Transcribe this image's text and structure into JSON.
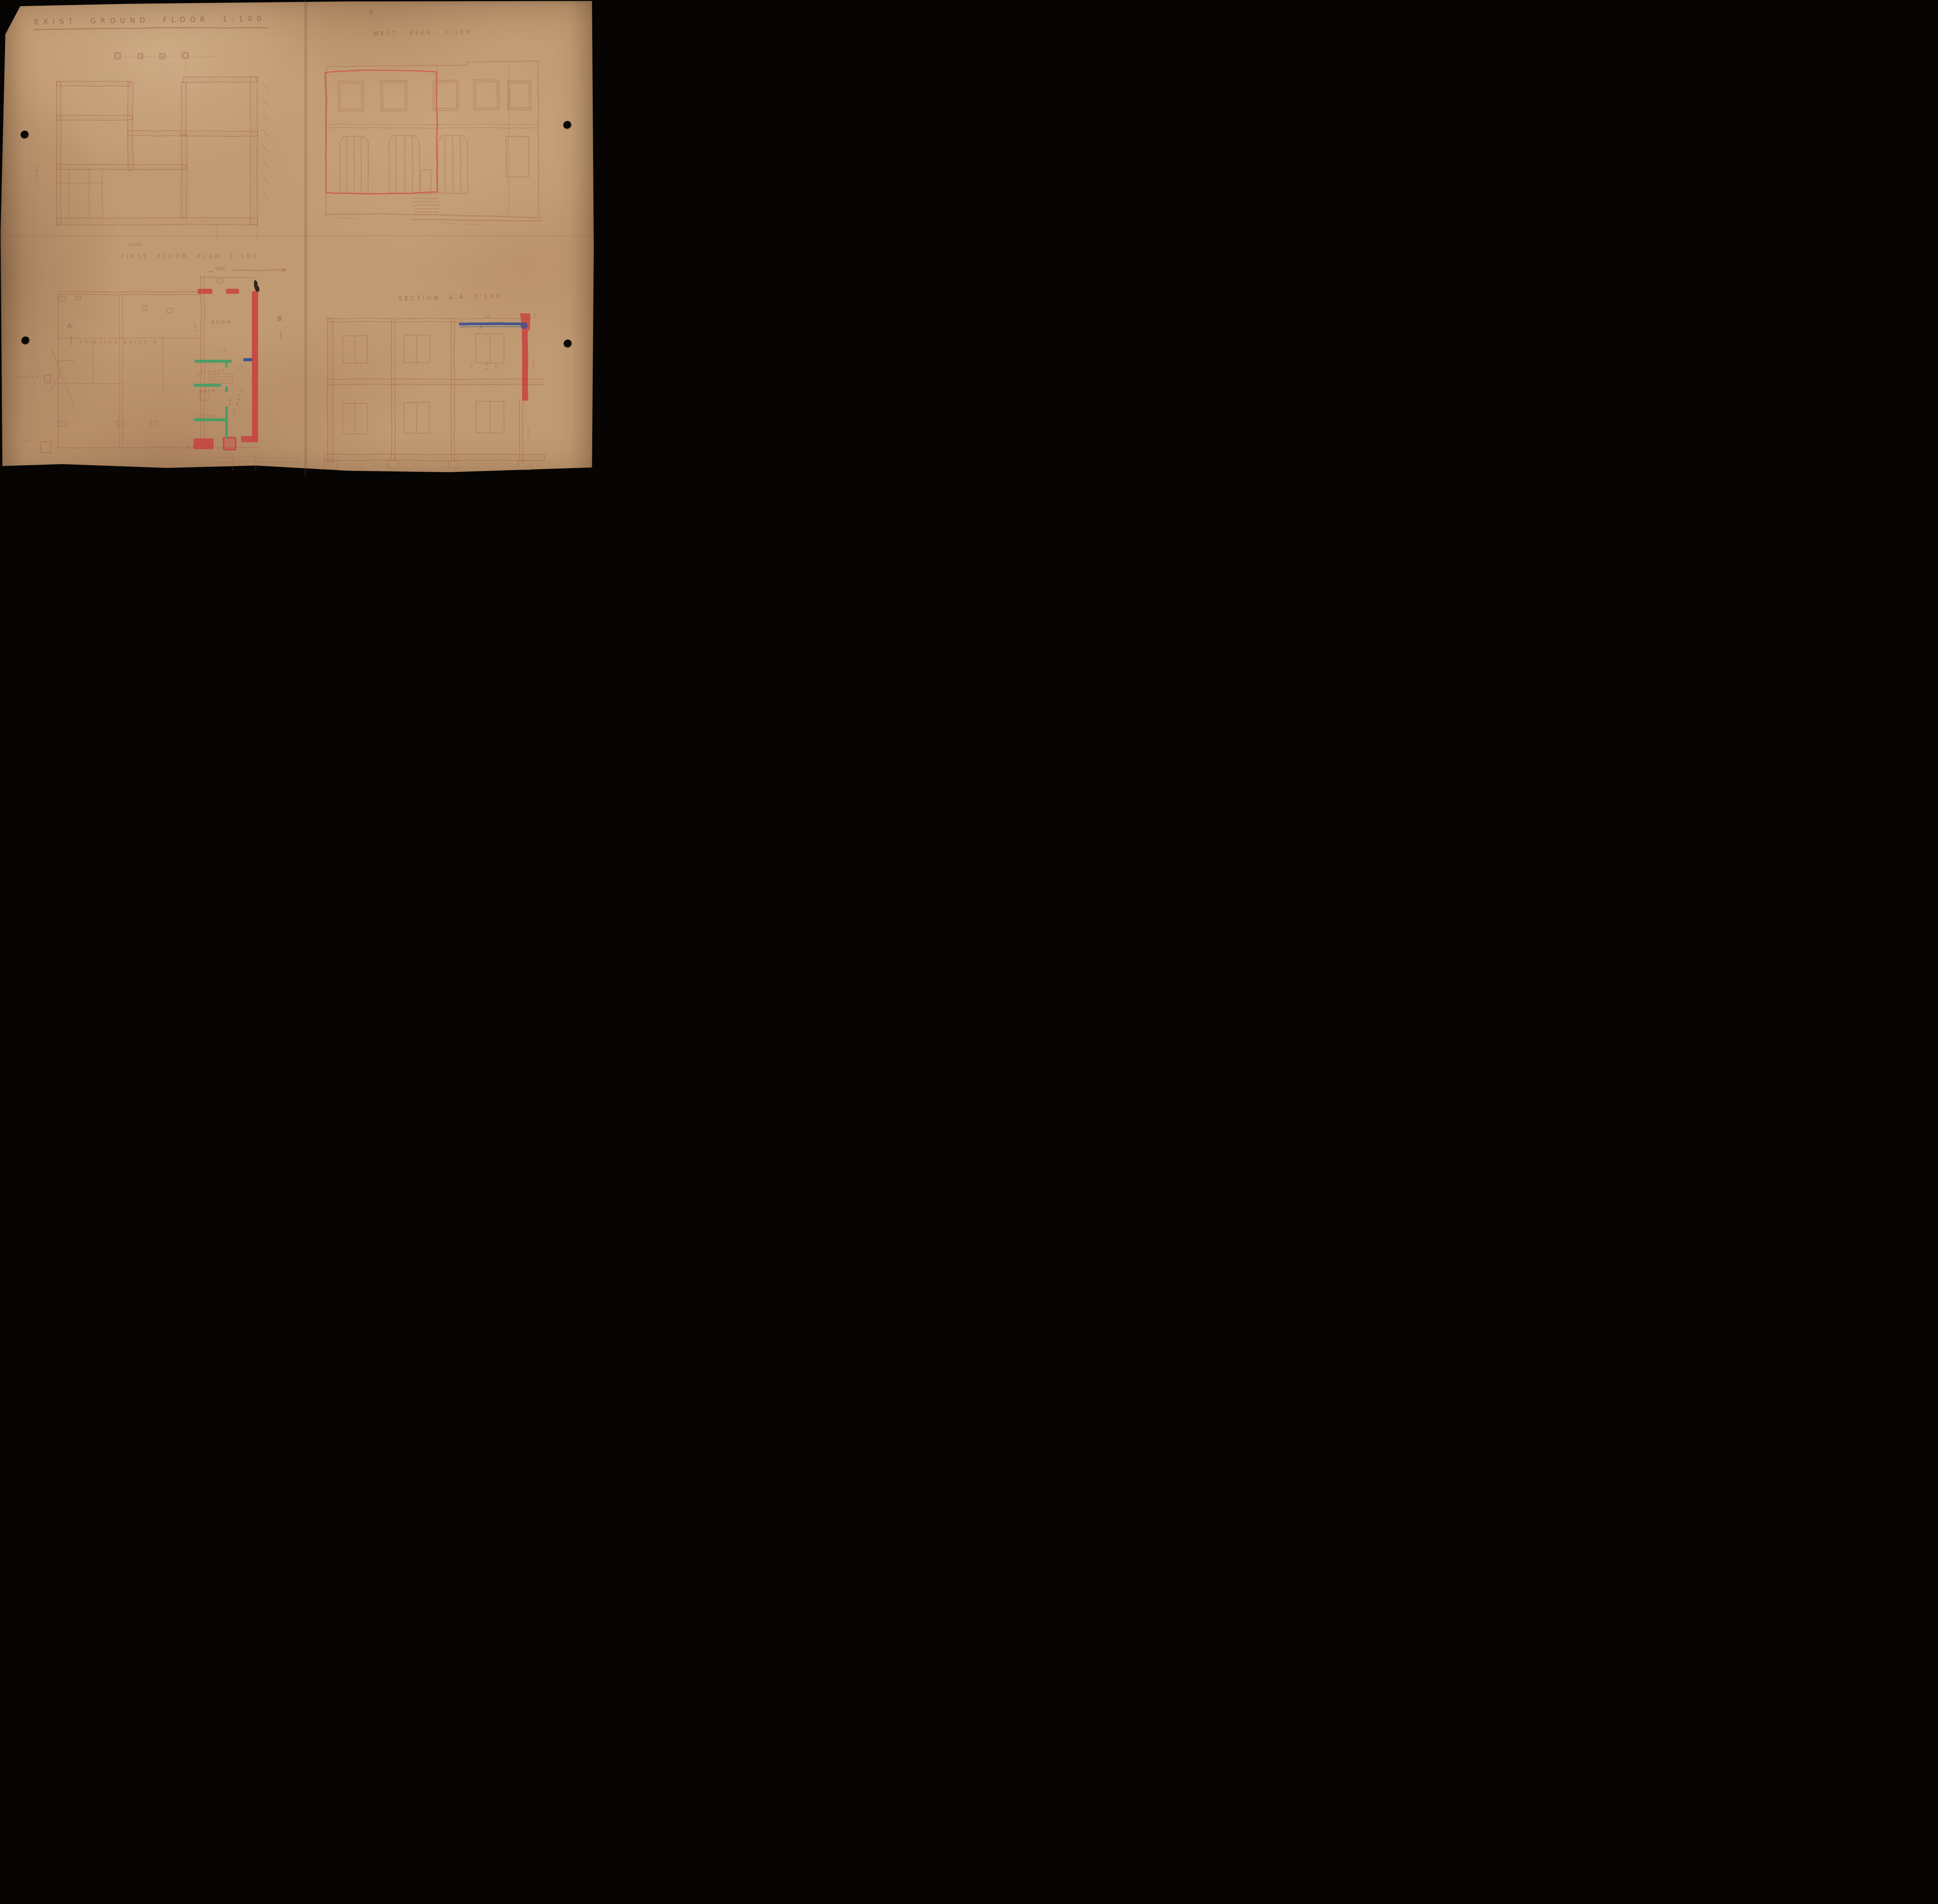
{
  "colors": {
    "pencil": "#9b5a43",
    "red_crayon": "#c84040",
    "green_crayon": "#3f9e62",
    "blue_crayon": "#2d4e94",
    "paper": "#c09a72",
    "ink": "#241a12"
  },
  "ground_floor": {
    "title": "EXIST GROUND FLOOR 1:100",
    "dim_side": "10.00",
    "dim_bottom": "1400"
  },
  "west_elevation": {
    "title": "WEST. ELEV. 1:100"
  },
  "first_floor": {
    "title": "FIRST FLOOR PLAN 1:100",
    "dim_top": "450",
    "existing_label": "EXISTING BUILD'G",
    "rooms": {
      "room": "ROOM",
      "kitchen": "KITCHEN",
      "bath": "BATH",
      "hall": "HALL",
      "lobby": "LOBBY"
    },
    "marker_a": "A.",
    "marker_b": "B.",
    "exist_pp": "EXIST. P.P.",
    "exist_mh": "EXIST M.H",
    "mh": "M.H",
    "ma": "M.A.",
    "dims": {
      "d335": "3.35",
      "d410": "4.10",
      "d270": "2.70",
      "d490": "4.90",
      "d140": "1.40"
    }
  },
  "section": {
    "title": "SECTION A.A 1:100",
    "bench_mark": "T",
    "dims": {
      "d80": "80",
      "d40": "40",
      "d330": "3.30",
      "d150": "1.50",
      "d360": "3.60",
      "d400": "4.00"
    }
  }
}
